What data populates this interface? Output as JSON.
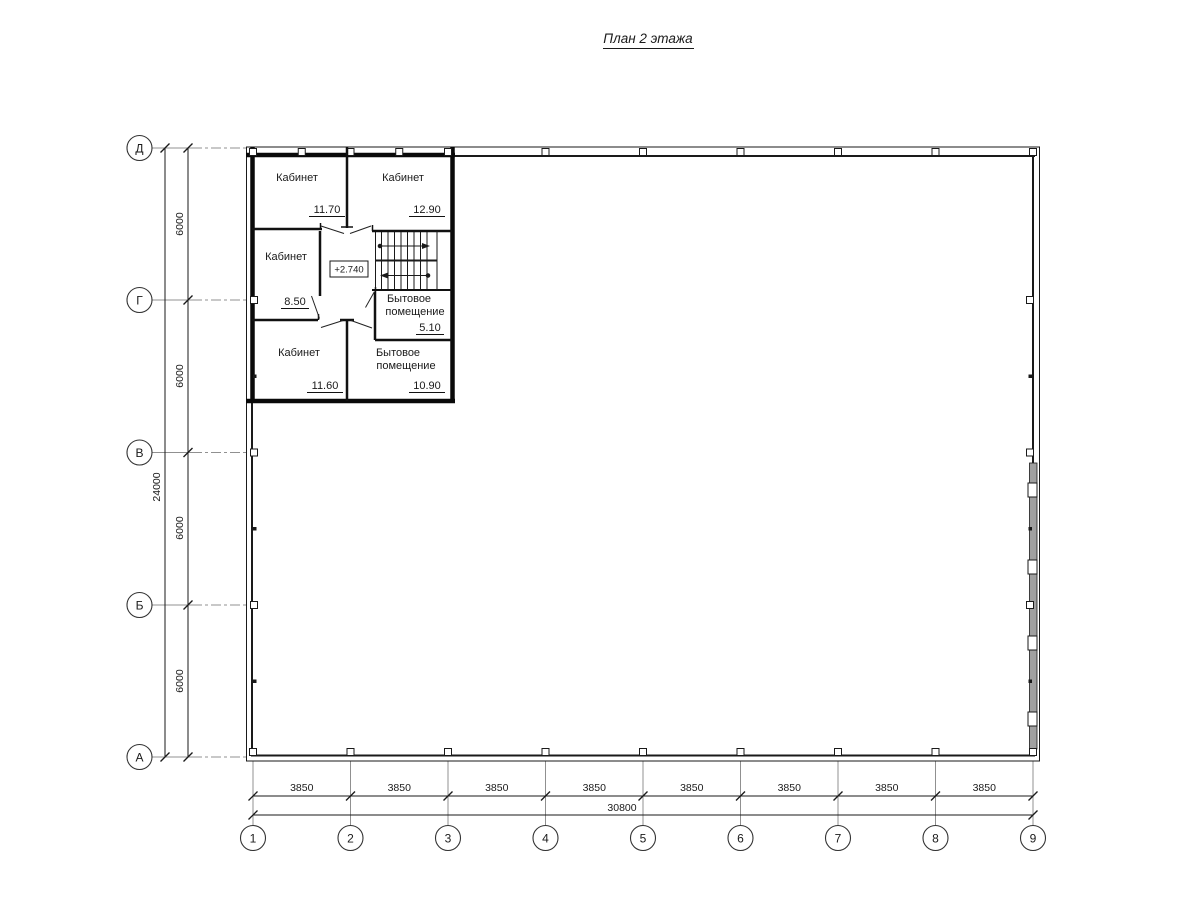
{
  "title": {
    "text": "План 2 этажа"
  },
  "axes": {
    "rows": [
      {
        "label": "Д"
      },
      {
        "label": "Г"
      },
      {
        "label": "В"
      },
      {
        "label": "Б"
      },
      {
        "label": "А"
      }
    ],
    "cols": [
      {
        "label": "1"
      },
      {
        "label": "2"
      },
      {
        "label": "3"
      },
      {
        "label": "4"
      },
      {
        "label": "5"
      },
      {
        "label": "6"
      },
      {
        "label": "7"
      },
      {
        "label": "8"
      },
      {
        "label": "9"
      }
    ]
  },
  "dims": {
    "left": {
      "segments": [
        "6000",
        "6000",
        "6000",
        "6000"
      ],
      "total": "24000"
    },
    "bottom": {
      "segments": [
        "3850",
        "3850",
        "3850",
        "3850",
        "3850",
        "3850",
        "3850",
        "3850"
      ],
      "total": "30800"
    }
  },
  "rooms": {
    "cab1": {
      "label": "Кабинет",
      "area": "11.70"
    },
    "cab2": {
      "label": "Кабинет",
      "area": "12.90"
    },
    "cab3": {
      "label": "Кабинет",
      "area": "8.50"
    },
    "cab4": {
      "label": "Кабинет",
      "area": "11.60"
    },
    "util1": {
      "line1": "Бытовое",
      "line2": "помещение",
      "area": "5.10"
    },
    "util2": {
      "line1": "Бытовое",
      "line2": "помещение",
      "area": "10.90"
    }
  },
  "level_mark": {
    "text": "+2.740"
  },
  "colors": {
    "line": "#1a1a1a",
    "axis_line": "#909090",
    "window_band": "#a0a0a0"
  }
}
